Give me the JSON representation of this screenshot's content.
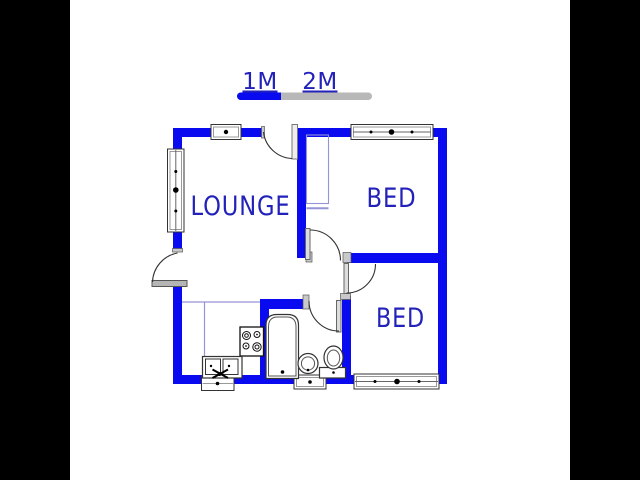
{
  "scale_bar": {
    "label_1m": "1M",
    "label_2m": "2M"
  },
  "rooms": {
    "lounge_label": "LOUNGE",
    "bed1_label": "BED",
    "bed2_label": "BED"
  },
  "fixtures": {
    "bathtub": "bathtub",
    "toilet": "toilet",
    "wash_basin": "wash-basin",
    "kitchen_sink": "double-kitchen-sink",
    "stove": "four-burner-stove",
    "cupboard": "built-in-cupboard"
  },
  "colors": {
    "wall": "#0a0af0",
    "label_text": "#2222bb",
    "scale_gray": "#b8b8b8",
    "thin_line": "#9494d6",
    "matte": "#000000",
    "background": "#ffffff"
  }
}
